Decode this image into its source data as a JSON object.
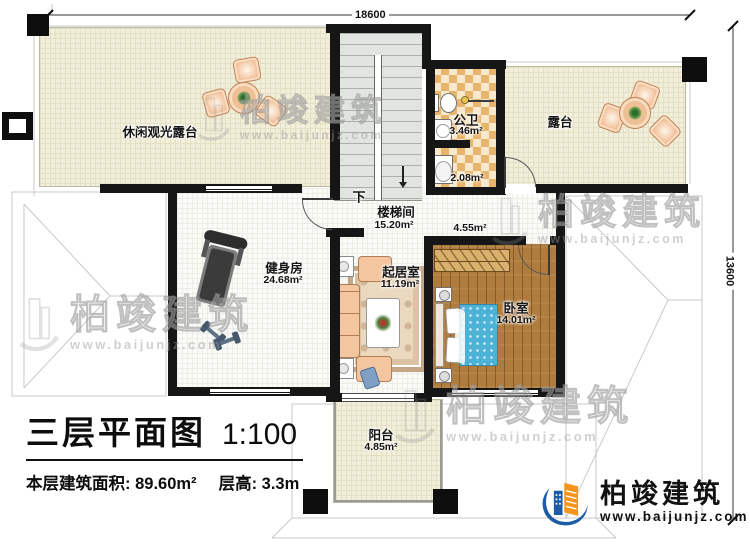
{
  "plan": {
    "dimensions": {
      "top": "18600",
      "right": "13600"
    },
    "stairs": {
      "down": "下"
    },
    "rooms": {
      "terrace_tl": {
        "name": "休闲观光露台"
      },
      "stairwell": {
        "name": "楼梯间",
        "area": "15.20m²"
      },
      "bathroom": {
        "name": "公卫",
        "area": "3.46m²"
      },
      "bath_lobby": {
        "area": "2.08m²"
      },
      "hall": {
        "area": "4.55m²"
      },
      "terrace_right": {
        "name": "露台"
      },
      "gym": {
        "name": "健身房",
        "area": "24.68m²"
      },
      "living": {
        "name": "起居室",
        "area": "11.19m²"
      },
      "bedroom": {
        "name": "卧室",
        "area": "14.01m²"
      },
      "balcony": {
        "name": "阳台",
        "area": "4.85m²"
      }
    }
  },
  "title_block": {
    "title": "三层平面图",
    "scale": "1:100",
    "area_label": "本层建筑面积:",
    "area_value": "89.60m²",
    "height_label": "层高:",
    "height_value": "3.3m"
  },
  "watermark": {
    "brand": "柏竣建筑",
    "site": "www.baijunjz.com"
  },
  "logo": {
    "brand": "柏竣建筑",
    "site": "www.baijunjz.com"
  }
}
